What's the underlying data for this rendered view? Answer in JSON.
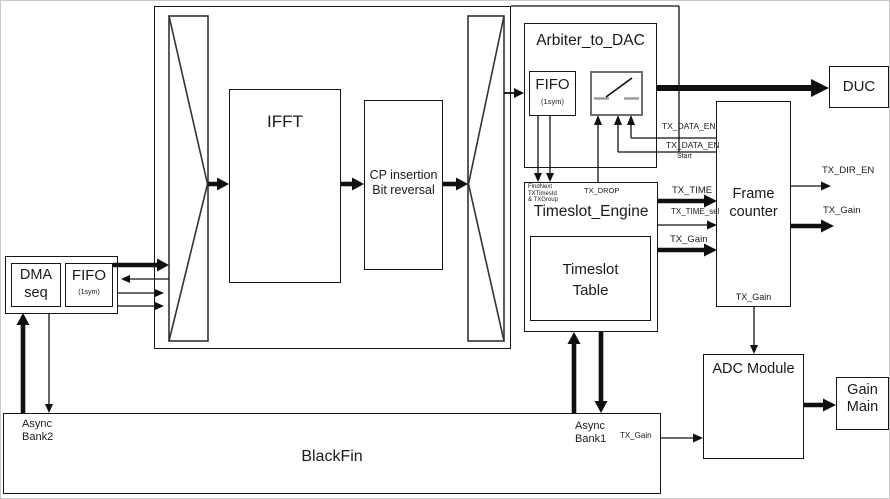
{
  "diagram": {
    "blocks": {
      "ifft": "IFFT",
      "cp_insertion": {
        "line1": "CP insertion",
        "line2": "Bit reversal"
      },
      "arbiter": {
        "title": "Arbiter_to_DAC",
        "fifo": "FIFO",
        "fifo_sub": "(1sym)"
      },
      "duc": "DUC",
      "timeslot_engine": {
        "title": "Timeslot_Engine",
        "note_line1": "FindNext",
        "note_line2": "TXTimesId",
        "note_line3": "& TXGroup",
        "table_line1": "Timeslot",
        "table_line2": "Table"
      },
      "frame_counter": {
        "line1": "Frame",
        "line2": "counter",
        "bottom_signal": "TX_Gain"
      },
      "adc": "ADC Module",
      "gain_main": {
        "line1": "Gain",
        "line2": "Main"
      },
      "dma": {
        "line1": "DMA",
        "line2": "seq"
      },
      "dma_fifo": {
        "label": "FIFO",
        "sub": "(1sym)"
      },
      "blackfin": {
        "title": "BlackFin",
        "bank2_line1": "Async",
        "bank2_line2": "Bank2",
        "bank1_line1": "Async",
        "bank1_line2": "Bank1"
      }
    },
    "signals": {
      "tx_data_en_top": "TX_DATA_EN",
      "tx_data_en_start": "TX_DATA_EN",
      "start": "Start",
      "tx_drop": "TX_DROP",
      "tx_time": "TX_TIME",
      "tx_time_sel": "TX_TIME_sel",
      "tx_gain_engine": "TX_Gain",
      "tx_dir_en": "TX_DIR_EN",
      "tx_gain_frame": "TX_Gain",
      "tx_gain_blackfin": "TX_Gain"
    },
    "colors": {
      "line": "#101010",
      "text": "#1a1a1a",
      "background": "#ffffff"
    }
  }
}
